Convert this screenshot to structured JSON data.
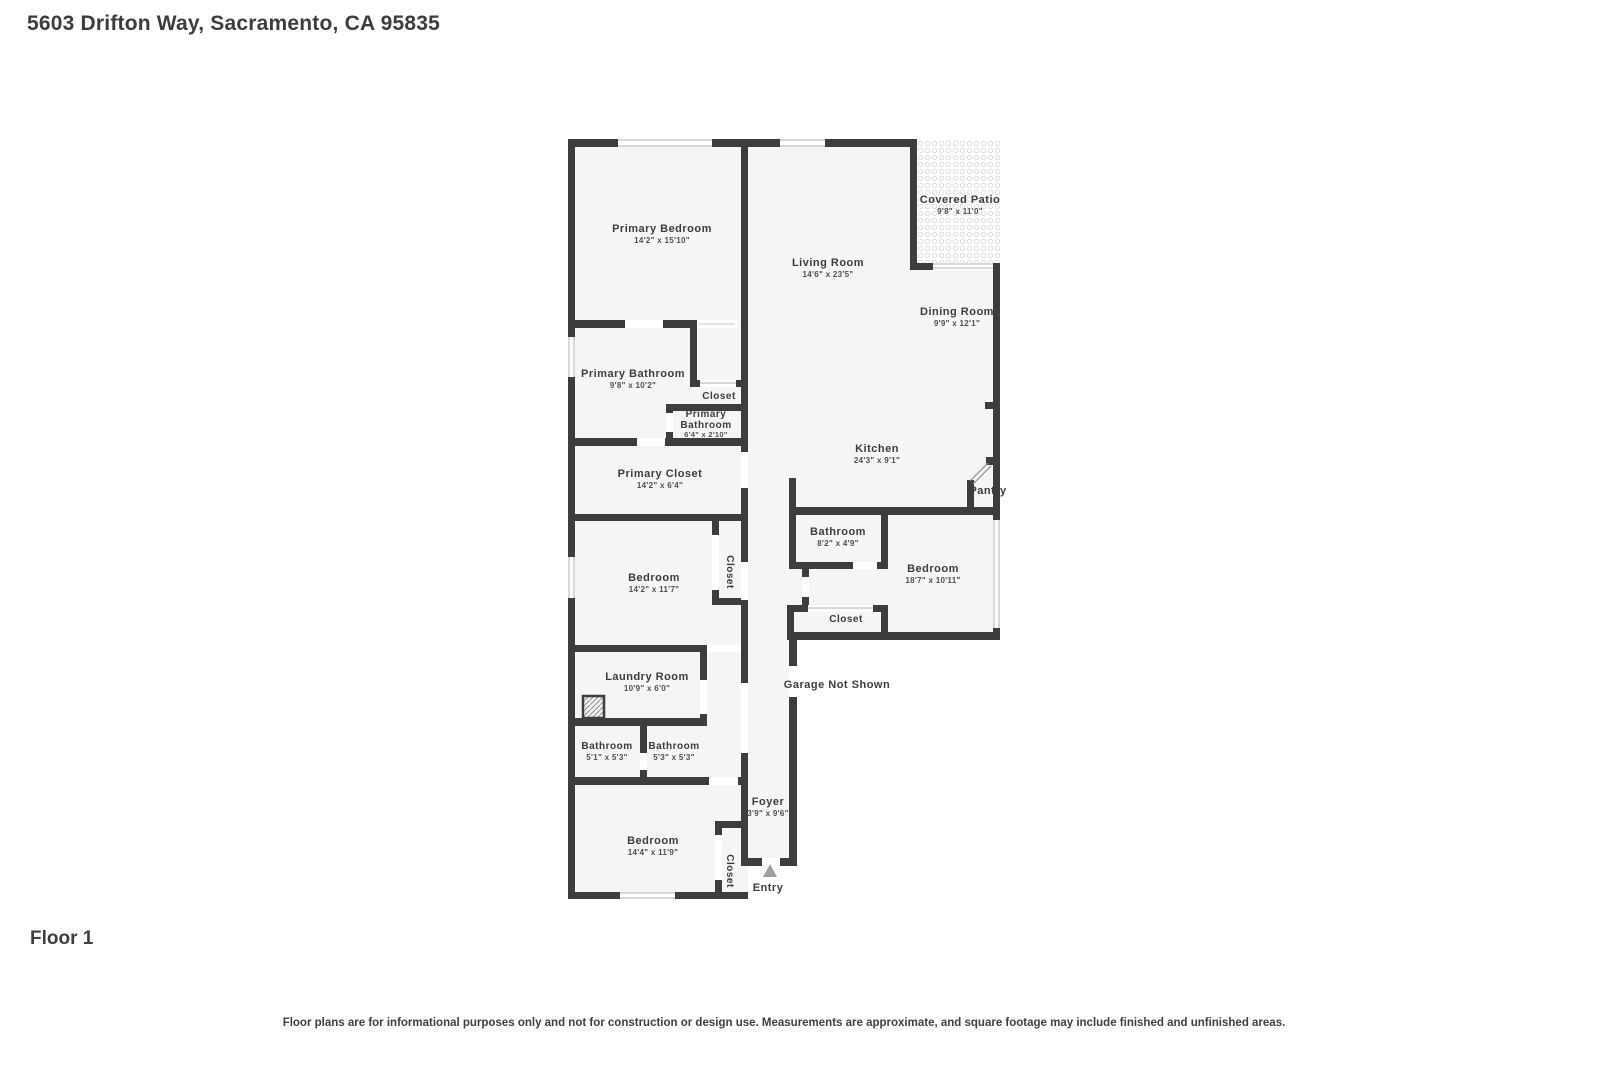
{
  "header": {
    "title": "5603 Drifton Way, Sacramento, CA 95835"
  },
  "floor": {
    "label": "Floor 1"
  },
  "footer": {
    "disclaimer": "Floor plans are for informational purposes only and not for construction or design use. Measurements are approximate, and square footage may include finished and unfinished areas."
  },
  "colors": {
    "wall": "#3d3d3d",
    "room_fill": "#f5f5f5",
    "label_text": "#3d3d3d",
    "dim_text": "#4f4f4f",
    "window_line": "#b0b0b0",
    "entry_arrow": "#9e9e9e"
  },
  "rooms": {
    "primary_bedroom": {
      "name": "Primary Bedroom",
      "dims": "14'2\" x 15'10\""
    },
    "living_room": {
      "name": "Living Room",
      "dims": "14'6\" x 23'5\""
    },
    "covered_patio": {
      "name": "Covered Patio",
      "dims": "9'8\" x 11'0\""
    },
    "dining_room": {
      "name": "Dining Room",
      "dims": "9'9\" x 12'1\""
    },
    "primary_bathroom": {
      "name": "Primary Bathroom",
      "dims": "9'8\" x 10'2\""
    },
    "closet_hall": {
      "name": "Closet"
    },
    "primary_bathroom_small": {
      "name_line1": "Primary",
      "name_line2": "Bathroom",
      "dims": "6'4\" x 2'10\""
    },
    "primary_closet": {
      "name": "Primary Closet",
      "dims": "14'2\" x 6'4\""
    },
    "kitchen": {
      "name": "Kitchen",
      "dims": "24'3\" x 9'1\""
    },
    "pantry": {
      "name": "Pantry"
    },
    "bathroom_right": {
      "name": "Bathroom",
      "dims": "8'2\" x 4'9\""
    },
    "bedroom_right": {
      "name": "Bedroom",
      "dims": "18'7\" x 10'11\""
    },
    "closet_right": {
      "name": "Closet"
    },
    "bedroom_left": {
      "name": "Bedroom",
      "dims": "14'2\" x 11'7\""
    },
    "closet_left": {
      "name": "Closet"
    },
    "laundry": {
      "name": "Laundry Room",
      "dims": "10'9\" x 6'0\""
    },
    "garage": {
      "name": "Garage Not Shown"
    },
    "bathroom_a": {
      "name": "Bathroom",
      "dims": "5'1\" x 5'3\""
    },
    "bathroom_b": {
      "name": "Bathroom",
      "dims": "5'3\" x 5'3\""
    },
    "bedroom_bottom": {
      "name": "Bedroom",
      "dims": "14'4\" x 11'9\""
    },
    "closet_bottom": {
      "name": "Closet"
    },
    "foyer": {
      "name": "Foyer",
      "dims": "3'9\" x 9'6\""
    },
    "entry": {
      "name": "Entry"
    }
  }
}
